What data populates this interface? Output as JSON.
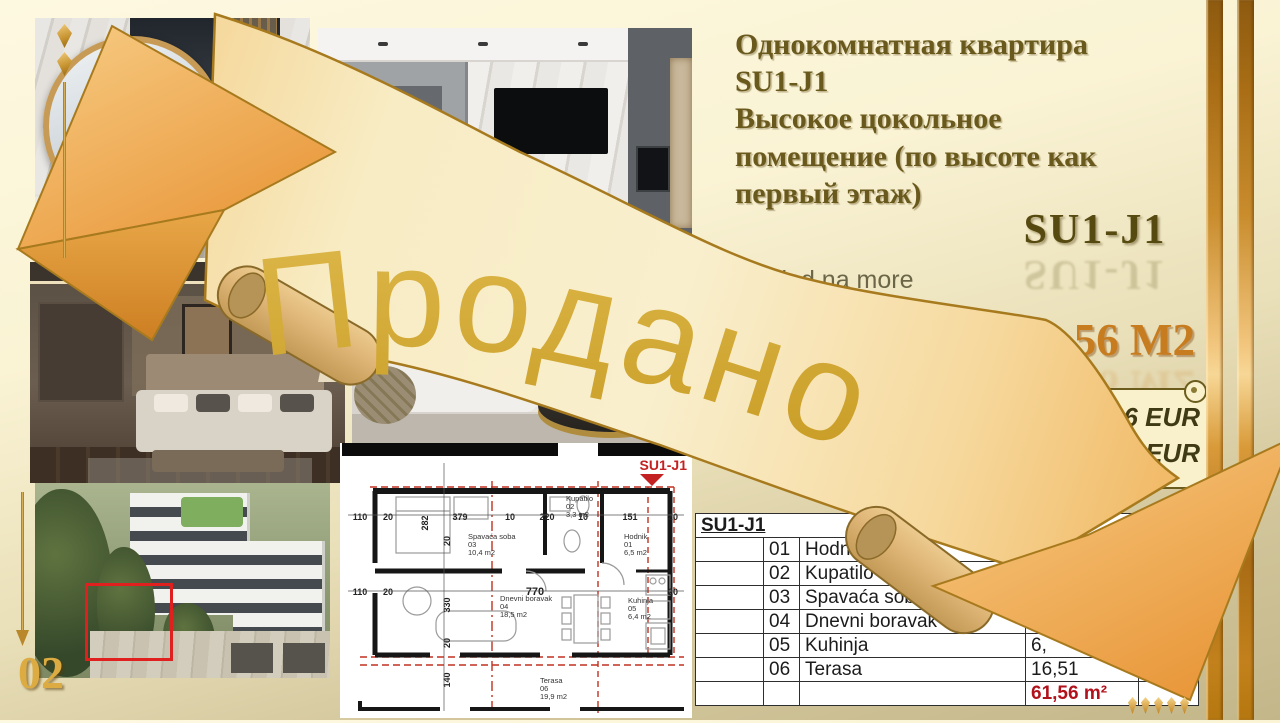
{
  "page_number": "02",
  "header": {
    "title": "Однокомнатная квартира\nSU1-J1\nВысокое цокольное\nпомещение (по высоте как\nпервый этаж)",
    "unit_deco": "SU1-J1",
    "view_note": "Pogled na more",
    "area_big": "61,56 M2"
  },
  "price": {
    "line1": "836 EUR",
    "line2": "EUR"
  },
  "banner_text": "Продано",
  "table": {
    "header": "SU1-J1",
    "rows": [
      [
        "",
        "01",
        "Hodnik",
        "",
        "13,09"
      ],
      [
        "",
        "02",
        "Kupatilo",
        "",
        "7,32"
      ],
      [
        "",
        "03",
        "Spavaća soba",
        "",
        "3,07"
      ],
      [
        "",
        "04",
        "Dnevni boravak",
        "",
        "84"
      ],
      [
        "",
        "05",
        "Kuhinja",
        "6,",
        "0"
      ],
      [
        "",
        "06",
        "Terasa",
        "16,51",
        ""
      ],
      [
        "",
        "",
        "",
        "61,56 m²",
        ""
      ]
    ]
  },
  "plan": {
    "unit": "SU1-J1",
    "dims_top": [
      "110",
      "20",
      "282",
      "379",
      "10",
      "220",
      "10",
      "151",
      "20"
    ],
    "dims_mid": [
      "110",
      "20",
      "770",
      "20"
    ],
    "dims_v": [
      "20",
      "330",
      "20",
      "140"
    ],
    "rooms": [
      {
        "name": "Spavaća soba",
        "num": "03",
        "area": "10,4 m2"
      },
      {
        "name": "Kupatilo",
        "num": "02",
        "area": "3,3 m2"
      },
      {
        "name": "Hodnik",
        "num": "01",
        "area": "6,5 m2"
      },
      {
        "name": "Dnevni boravak",
        "num": "04",
        "area": "18,5 m2"
      },
      {
        "name": "Kuhinja",
        "num": "05",
        "area": "6,4 m2"
      },
      {
        "name": "Terasa",
        "num": "06",
        "area": "19,9 m2"
      }
    ]
  },
  "colors": {
    "accent_gold": "#c9a23c",
    "sold_text": "#d2a62e",
    "area_orange": "#c87c20",
    "table_total_red": "#b1121b"
  }
}
